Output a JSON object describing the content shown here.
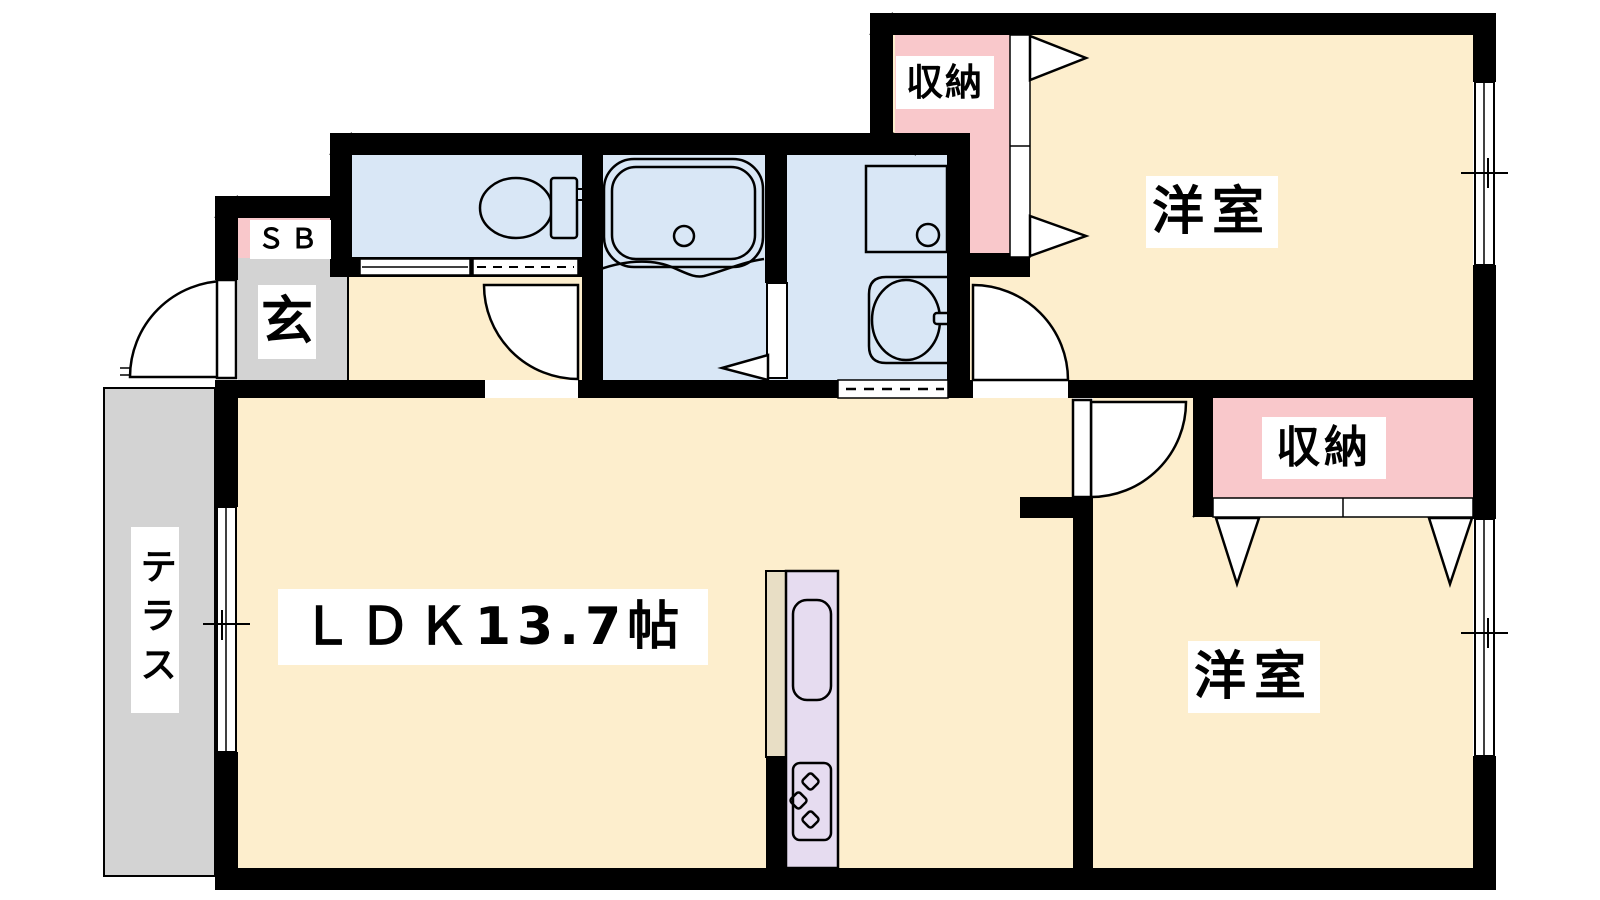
{
  "plan": {
    "rooms": {
      "ldk": {
        "label": "ＬＤＫ13.7帖"
      },
      "bedroom_top": {
        "label": "洋室"
      },
      "bedroom_bottom": {
        "label": "洋室"
      },
      "closet_top": {
        "label": "収納"
      },
      "closet_bottom": {
        "label": "収納"
      },
      "shoe_box": {
        "label": "ＳＢ"
      },
      "entrance": {
        "label": "玄"
      },
      "terrace": {
        "label": "テラス"
      }
    },
    "fixtures": [
      "toilet",
      "bathtub",
      "washing-machine",
      "vanity-sink",
      "kitchen-sink",
      "gas-stove"
    ],
    "colors": {
      "floor": "#FDEECD",
      "wet_area": "#D9E7F6",
      "closet": "#F9C8CB",
      "gray_area": "#D3D3D3",
      "kitchen_counter": "#E6DCF0",
      "counter_side": "#E8DEC5",
      "wall": "#000000"
    }
  }
}
